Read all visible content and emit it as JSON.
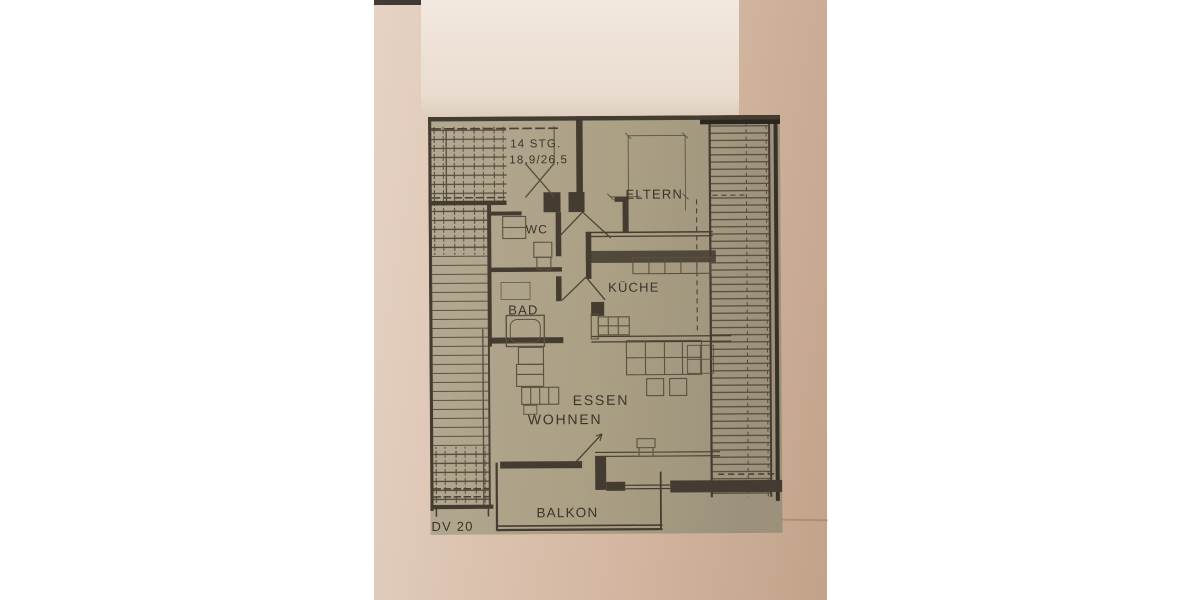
{
  "floor_plan": {
    "drawing_code": "DV 20",
    "stairs_note": {
      "line1": "14 STG.",
      "line2": "18,9/26,5"
    },
    "rooms": [
      {
        "id": "eltern",
        "label": "ELTERN"
      },
      {
        "id": "wc",
        "label": "WC"
      },
      {
        "id": "kueche",
        "label": "KÜCHE"
      },
      {
        "id": "bad",
        "label": "BAD"
      },
      {
        "id": "essen",
        "label": "ESSEN"
      },
      {
        "id": "wohnen",
        "label": "WOHNEN"
      },
      {
        "id": "balkon",
        "label": "BALKON"
      }
    ],
    "colors": {
      "page_background": "#ffffff",
      "photo_paper": "#d7bda9",
      "plan_paper": "#aca188",
      "ink": "#443c30"
    }
  }
}
